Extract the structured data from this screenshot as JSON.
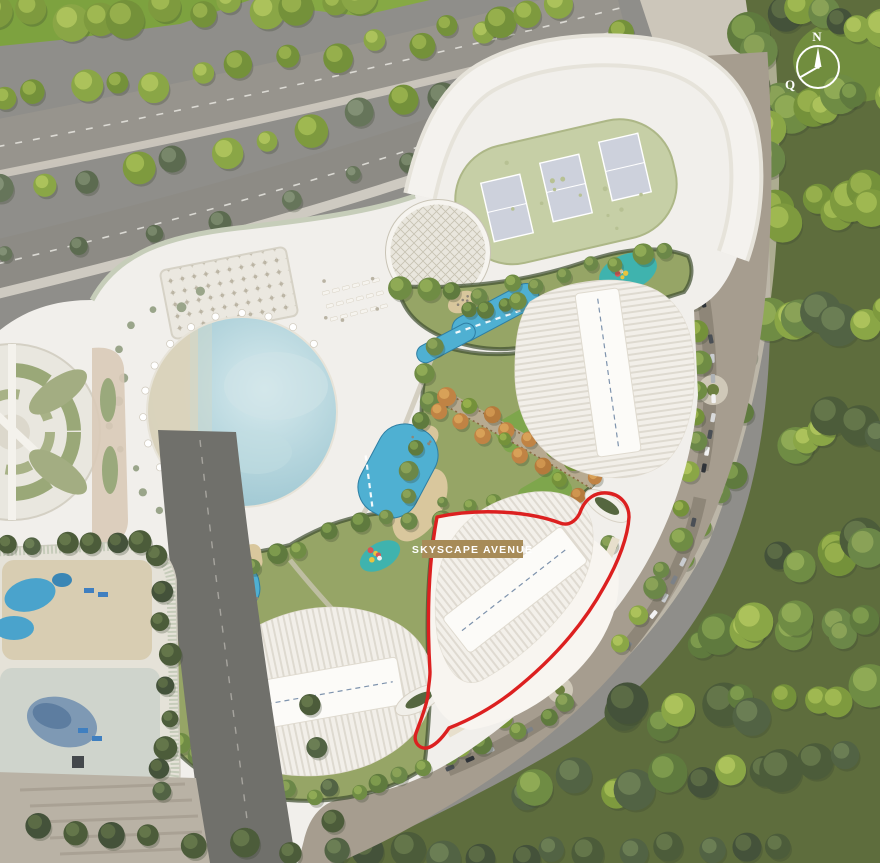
{
  "parcel": {
    "label": "SKYSCAPE AVENUE",
    "badge_color": "#a78b58",
    "label_text_color": "#ffffff",
    "outline_color": "#dc2020"
  },
  "compass": {
    "north_label": "N",
    "qibla_label": "Q",
    "color": "#ffffff"
  },
  "palette": {
    "podium": "#f1efeb",
    "parkland_green": "#5e6d3d",
    "pool_blue": "#4fb0d2",
    "lagoon_blue": "#aed2da",
    "playground_teal": "#3fb3ae",
    "lawn_green": "#7ea64c",
    "road_gray": "#8f8e8a",
    "parking_gray": "#a69d8f",
    "asphalt_dark": "#70706b"
  }
}
